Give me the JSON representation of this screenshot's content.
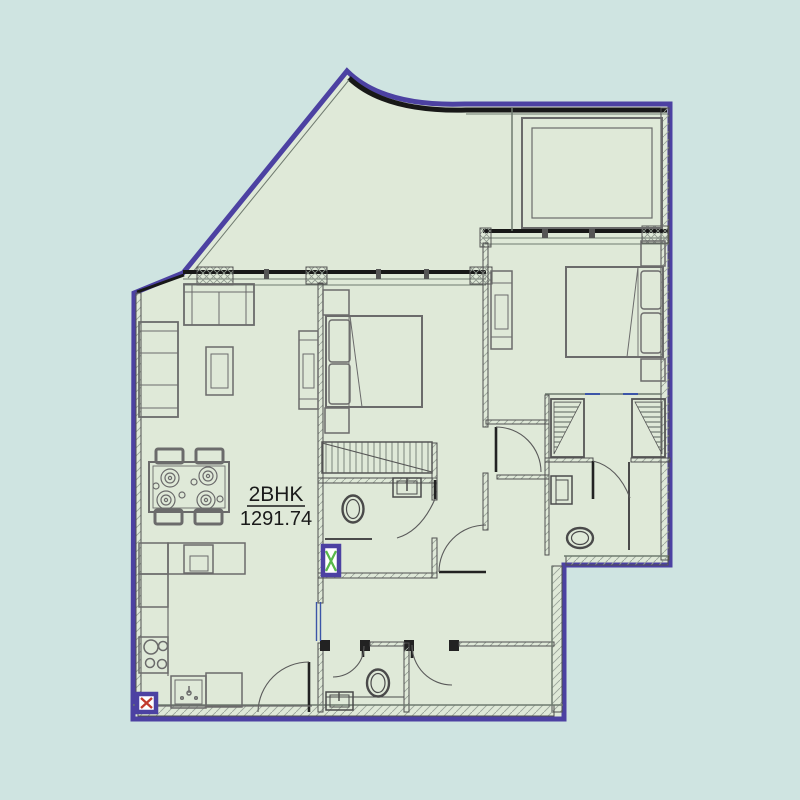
{
  "plan": {
    "unit_label": "2BHK",
    "area_value": "1291.74"
  },
  "colors": {
    "background": "#cfe4e1",
    "floor": "#dfe9d8",
    "boundary": "#4c41a2",
    "boundary_dark": "#181818",
    "wall": "#4f4f4f",
    "furniture": "#6b6b6b",
    "hatch": "#9aa49a",
    "window_blue": "#3c55a8",
    "shaft_x_red": "#c23b2e",
    "shaft_x_green": "#58b84a"
  }
}
